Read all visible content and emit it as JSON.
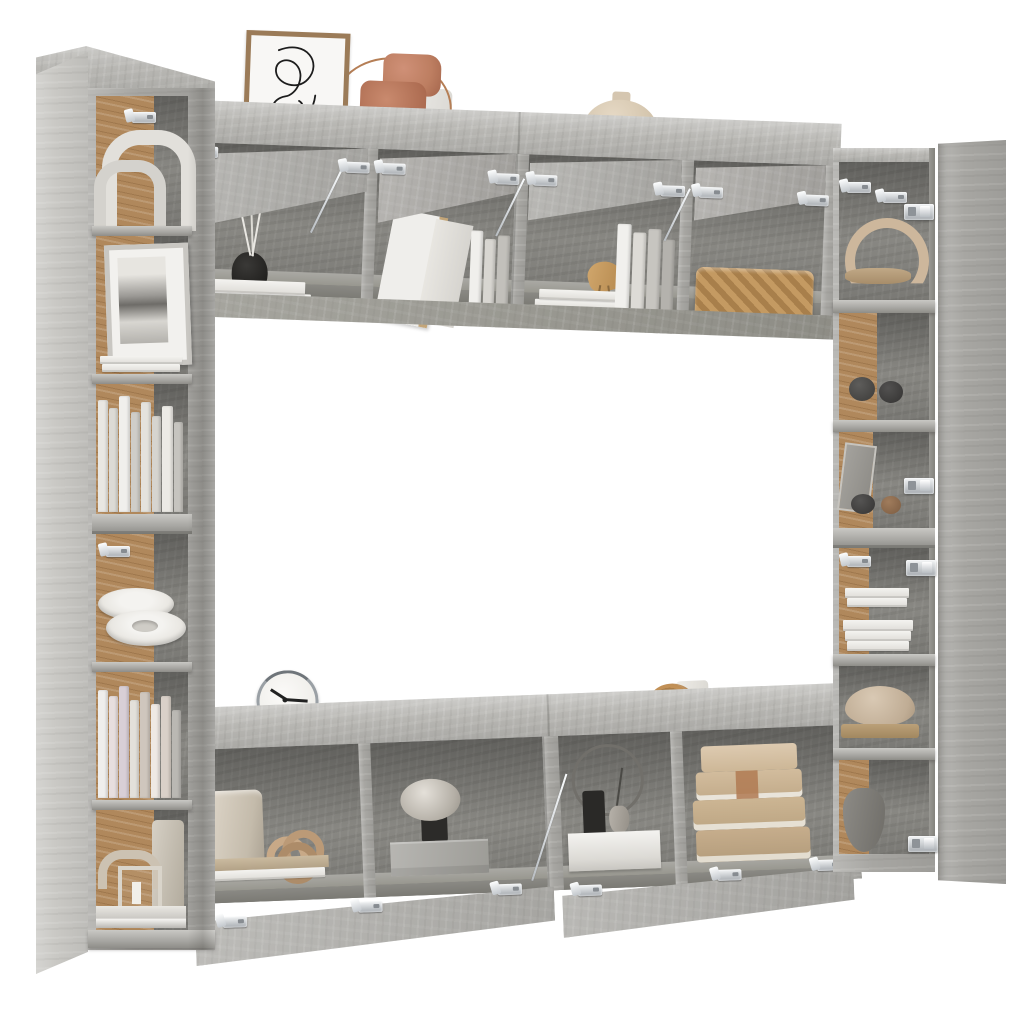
{
  "meta": {
    "type": "product-photo",
    "description": "Eight-piece TV wall unit set in concrete grey engineered wood arranged as an open square frame with styled open shelves, floating on a plain white studio background",
    "background": "#ffffff"
  },
  "palette": {
    "bg": "#ffffff",
    "concrete-light": "#c9c8c4",
    "concrete-top": "#b8b7b3",
    "concrete-mid": "#a7a6a2",
    "concrete-deep": "#93928d",
    "concrete-interior": "#8e8d88",
    "concrete-shadow": "#7a7973",
    "cork": "#b0885c",
    "cork-dark": "#9a7344",
    "white-decor": "#eae8e3",
    "paper": "#dcdad4",
    "beige": "#d7c5af",
    "tan": "#c0a787",
    "wood": "#b08a57",
    "terracotta": "#bd7e61",
    "copper": "#b57e55",
    "charcoal": "#2e2d2b",
    "stone": "#c5c1ba",
    "metal-light": "#f3f5f6",
    "metal-dark": "#a6abb0"
  },
  "scene": {
    "label": "8-piece TV wall unit set - concrete grey",
    "clock_time": "10:15",
    "units": [
      {
        "id": "tall-cabinet-left-upper",
        "label": "Tall wall cabinet, left (upper)"
      },
      {
        "id": "tall-cabinet-left-lower",
        "label": "Tall wall cabinet, left (lower)"
      },
      {
        "id": "wall-cabinet-top-left",
        "label": "Wall cabinet with open flip-up doors, top left"
      },
      {
        "id": "wall-cabinet-top-right",
        "label": "Wall cabinet with open flip-up doors, top right"
      },
      {
        "id": "tall-cabinet-right",
        "label": "Tall open shelf cabinet, right"
      },
      {
        "id": "door-cabinet-right",
        "label": "Tall cabinet with open hinged door, far right"
      },
      {
        "id": "tv-bench-left",
        "label": "TV bench with open drop-down door, bottom left"
      },
      {
        "id": "tv-bench-right",
        "label": "TV bench with open drop-down door, bottom right"
      }
    ],
    "decor": {
      "left_cabinet": [
        "white arch sculptures",
        "mounting bracket",
        "framed monochrome photo",
        "stack of art prints",
        "row of white books",
        "stacked ceramic platters",
        "row of pastel books",
        "arch ornament",
        "candle lantern",
        "ceramic cylinder vase",
        "storage tray"
      ],
      "top_cabinets": [
        "abstract line-art in oak frame",
        "terracotta cork sculpture",
        "white ceramic vase",
        "copper wire hoop",
        "grey platter",
        "sand donut vase",
        "black reed diffuser",
        "magazine stack",
        "leaning art boards",
        "upright books",
        "wooden bird figurine",
        "seagrass basket"
      ],
      "right_cabinet": [
        "leather strap bowl",
        "dark ceramic bowls",
        "leaning slate frame",
        "clay sphere",
        "white book stacks",
        "linen pouf ornament",
        "grey stone vase"
      ],
      "tv_benches": [
        "desk clock",
        "oak disc",
        "candle cup",
        "raw ceramic vessel",
        "wooden knot sculpture",
        "plinth of books",
        "stone mushroom lamp",
        "grey gift box",
        "wire hoop ornament",
        "mini bud vases",
        "white riser box",
        "stack of linen-bound books"
      ]
    }
  }
}
